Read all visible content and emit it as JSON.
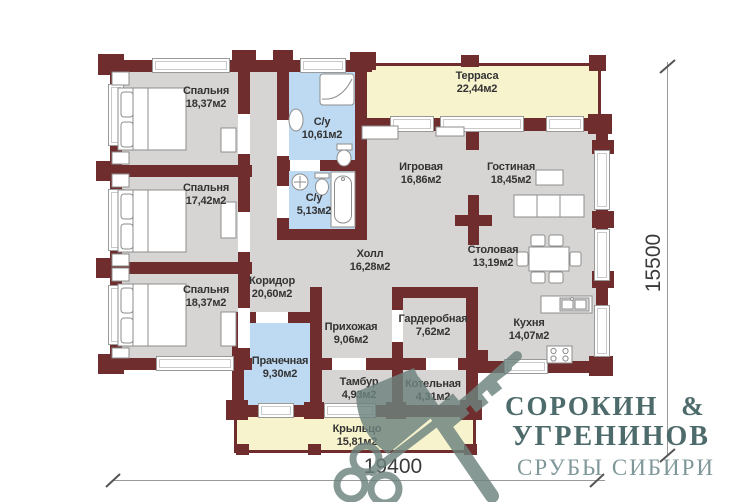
{
  "plan_title": "floor-plan-log-house",
  "rooms": [
    {
      "name": "Спальня",
      "area": "18,37м2"
    },
    {
      "name": "С/у",
      "area": "10,61м2"
    },
    {
      "name": "Терраса",
      "area": "22,44м2"
    },
    {
      "name": "Спальня",
      "area": "17,42м2"
    },
    {
      "name": "С/у",
      "area": "5,13м2"
    },
    {
      "name": "Игровая",
      "area": "16,86м2"
    },
    {
      "name": "Гостиная",
      "area": "18,45м2"
    },
    {
      "name": "Холл",
      "area": "16,28м2"
    },
    {
      "name": "Столовая",
      "area": "13,19м2"
    },
    {
      "name": "Спальня",
      "area": "18,37м2"
    },
    {
      "name": "Коридор",
      "area": "20,60м2"
    },
    {
      "name": "Прихожая",
      "area": "9,06м2"
    },
    {
      "name": "Гардеробная",
      "area": "7,62м2"
    },
    {
      "name": "Кухня",
      "area": "14,07м2"
    },
    {
      "name": "Прачечная",
      "area": "9,30м2"
    },
    {
      "name": "Тамбур",
      "area": "4,93м2"
    },
    {
      "name": "Котельная",
      "area": "4,31м2"
    },
    {
      "name": "Крыльцо",
      "area": "15,81м2"
    }
  ],
  "dimensions": {
    "width_mm": "19400",
    "height_mm": "15500"
  },
  "logo": {
    "line1": "СОРОКИН &",
    "line2": "УГРЕНИНОВ",
    "line3": "СРУБЫ СИБИРИ"
  },
  "colors": {
    "wall": "#6f2d2d",
    "room_fill": "#d7d5d3",
    "wet_room_fill": "#bedaf2",
    "terrace_fill": "#f7f3cc",
    "logo_dark": "#4e6b6b",
    "logo_light": "#7f9798",
    "watermark": "#6d837e"
  }
}
